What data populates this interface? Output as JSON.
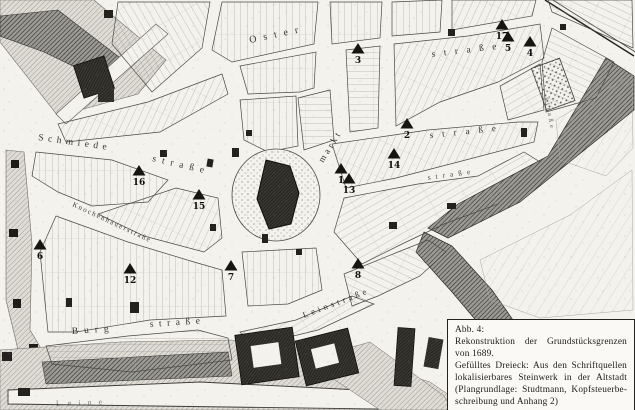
{
  "figure_caption": {
    "label": "Abb. 4:",
    "title": "Rekonstruktion der Grundstücksgrenzen von 1689.",
    "legend": "Gefülltes Dreieck: Aus den Schriftquellen lokalisierbares Steinwerk in der Altstadt (Plangrundlage: Studtmann, Kopfsteuerbe­schreibung und Anhang 2)"
  },
  "map": {
    "marker_symbol": "filled-triangle",
    "colors": {
      "ink": "#21211f",
      "paper": "#f3f2ed",
      "water": "#55534f"
    },
    "street_labels": [
      {
        "text": "Oster",
        "x": 250,
        "y": 43,
        "rot": -12,
        "ls": 7,
        "size": 10,
        "op": 0.9
      },
      {
        "text": "straße",
        "x": 432,
        "y": 57,
        "rot": -7,
        "ls": 8.5,
        "size": 9.5,
        "op": 0.9
      },
      {
        "text": "Schmiede",
        "x": 38,
        "y": 140,
        "rot": 8,
        "ls": 4.5,
        "size": 9.5,
        "op": 0.9
      },
      {
        "text": "straße",
        "x": 152,
        "y": 161,
        "rot": 13,
        "ls": 6,
        "size": 9.5,
        "op": 0.9
      },
      {
        "text": "markt",
        "x": 323,
        "y": 163,
        "rot": -58,
        "ls": 3,
        "size": 9,
        "op": 0.9
      },
      {
        "text": "straße",
        "x": 430,
        "y": 138,
        "rot": -6,
        "ls": 9,
        "size": 9,
        "op": 0.9
      },
      {
        "text": "straße",
        "x": 428,
        "y": 180,
        "rot": -8,
        "ls": 5,
        "size": 7.5,
        "op": 0.8
      },
      {
        "text": "Knochenhauerstraße",
        "x": 72,
        "y": 206,
        "rot": 25,
        "ls": 1.6,
        "size": 7,
        "op": 0.85
      },
      {
        "text": "Burg",
        "x": 72,
        "y": 334,
        "rot": -4,
        "ls": 6,
        "size": 9.5,
        "op": 0.9
      },
      {
        "text": "straße",
        "x": 150,
        "y": 327,
        "rot": -4,
        "ls": 5.5,
        "size": 9.5,
        "op": 0.9
      },
      {
        "text": "Leinstraße",
        "x": 304,
        "y": 318,
        "rot": -21,
        "ls": 3.5,
        "size": 8.5,
        "op": 0.9
      },
      {
        "text": "straße",
        "x": 545,
        "y": 98,
        "rot": 80,
        "ls": 3,
        "size": 6.5,
        "op": 0.7
      },
      {
        "text": "Leine",
        "x": 56,
        "y": 406,
        "rot": -2,
        "ls": 7,
        "size": 8,
        "op": 0.55
      }
    ],
    "markers": [
      {
        "n": "1",
        "x": 341,
        "y": 169
      },
      {
        "n": "2",
        "x": 407,
        "y": 124
      },
      {
        "n": "3",
        "x": 358,
        "y": 49
      },
      {
        "n": "4",
        "x": 530,
        "y": 42
      },
      {
        "n": "5",
        "x": 508,
        "y": 37
      },
      {
        "n": "6",
        "x": 40,
        "y": 245
      },
      {
        "n": "7",
        "x": 231,
        "y": 266
      },
      {
        "n": "8",
        "x": 358,
        "y": 264
      },
      {
        "n": "12",
        "x": 130,
        "y": 269
      },
      {
        "n": "13",
        "x": 349,
        "y": 179
      },
      {
        "n": "14",
        "x": 394,
        "y": 154
      },
      {
        "n": "15",
        "x": 199,
        "y": 195
      },
      {
        "n": "16",
        "x": 139,
        "y": 171
      },
      {
        "n": "17",
        "x": 502,
        "y": 25
      }
    ]
  }
}
